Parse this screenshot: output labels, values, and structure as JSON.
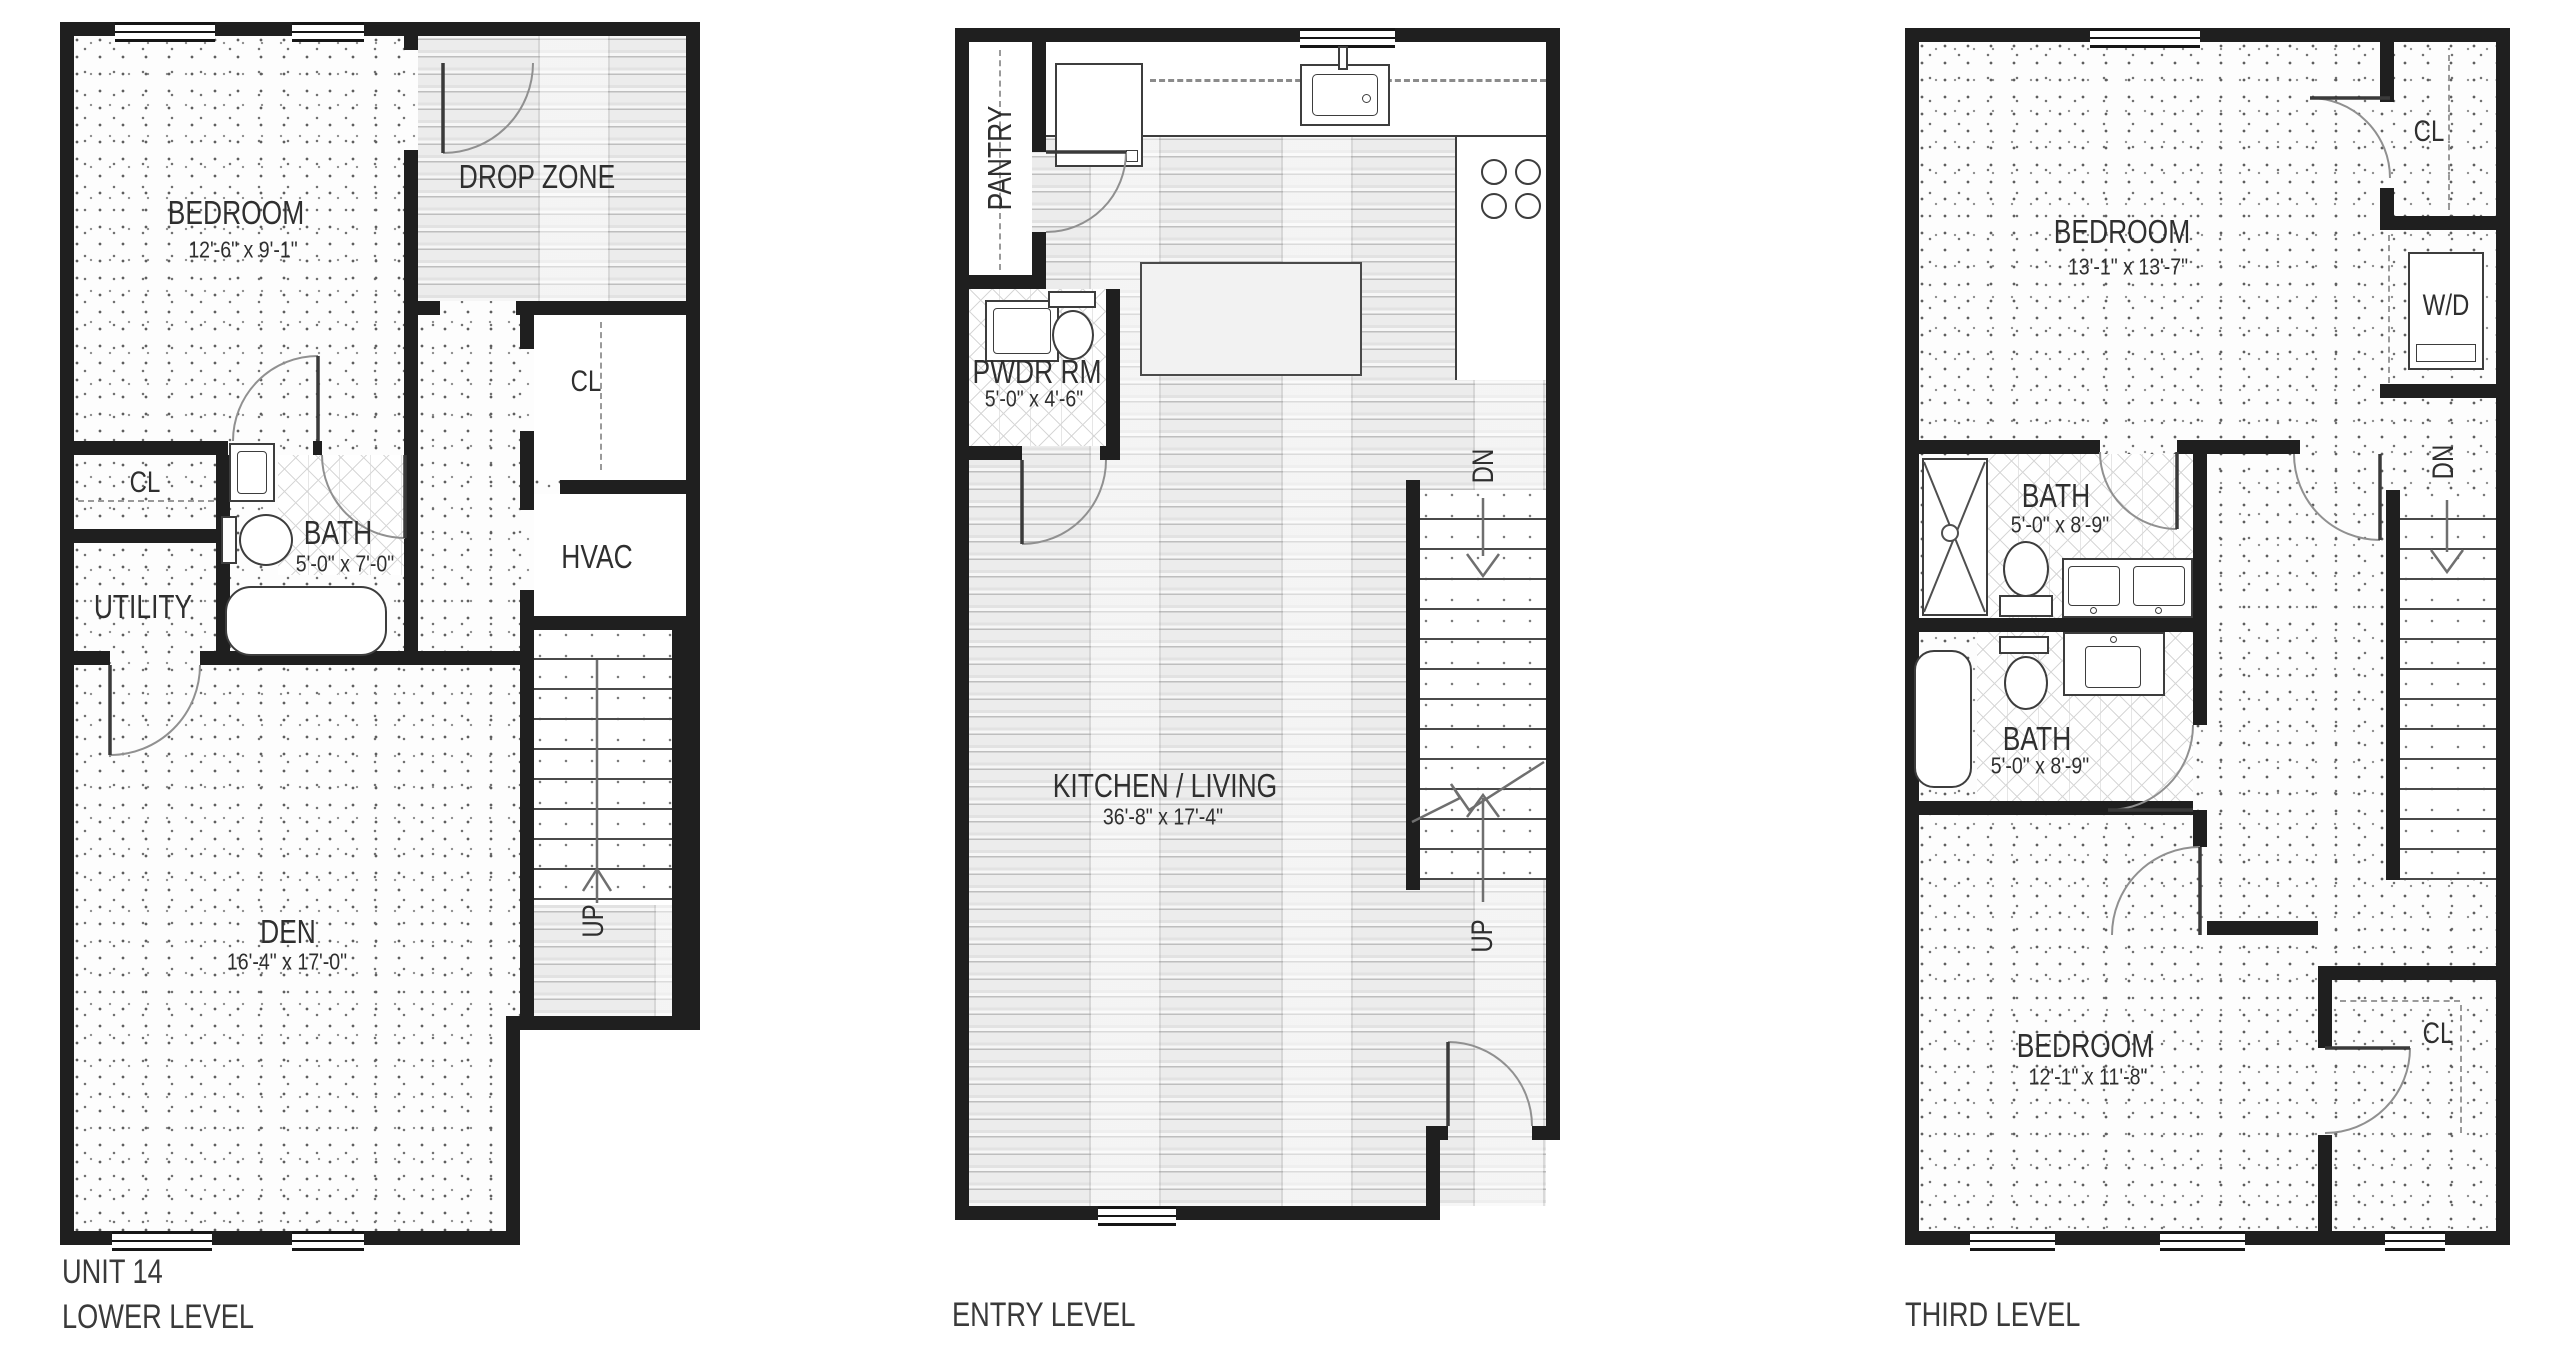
{
  "colors": {
    "wall": "#1f1f1f",
    "door_line": "#909090",
    "label": "#2f2f2f"
  },
  "plans": {
    "lower": {
      "caption1": "UNIT 14",
      "caption2": "LOWER LEVEL",
      "rooms": {
        "bedroom": {
          "name": "BEDROOM",
          "dims": "12'-6\" x 9'-1\""
        },
        "drop_zone": {
          "name": "DROP ZONE"
        },
        "closet_upper": {
          "name": "CL"
        },
        "closet_hall": {
          "name": "CL"
        },
        "bath": {
          "name": "BATH",
          "dims": "5'-0\" x 7'-0\""
        },
        "utility": {
          "name": "UTILITY"
        },
        "hvac": {
          "name": "HVAC"
        },
        "den": {
          "name": "DEN",
          "dims": "16'-4\" x 17'-0\""
        },
        "stairs": {
          "up": "UP"
        }
      }
    },
    "entry": {
      "caption": "ENTRY LEVEL",
      "rooms": {
        "pantry": {
          "name": "PANTRY"
        },
        "powder": {
          "name": "PWDR RM",
          "dims": "5'-0\" x 4'-6\""
        },
        "kitchen_living": {
          "name": "KITCHEN / LIVING",
          "dims": "36'-8\" x 17'-4\""
        },
        "stairs": {
          "down": "DN",
          "up": "UP"
        }
      }
    },
    "third": {
      "caption": "THIRD LEVEL",
      "rooms": {
        "bedroom_front": {
          "name": "BEDROOM",
          "dims": "13'-1\" x 13'-7\""
        },
        "closet_front": {
          "name": "CL"
        },
        "laundry": {
          "name": "W/D"
        },
        "bath_front": {
          "name": "BATH",
          "dims": "5'-0\" x 8'-9\""
        },
        "bath_rear": {
          "name": "BATH",
          "dims": "5'-0\" x 8'-9\""
        },
        "bedroom_rear": {
          "name": "BEDROOM",
          "dims": "12'-1\" x 11'-8\""
        },
        "closet_rear": {
          "name": "CL"
        },
        "stairs": {
          "down": "DN"
        }
      }
    }
  }
}
